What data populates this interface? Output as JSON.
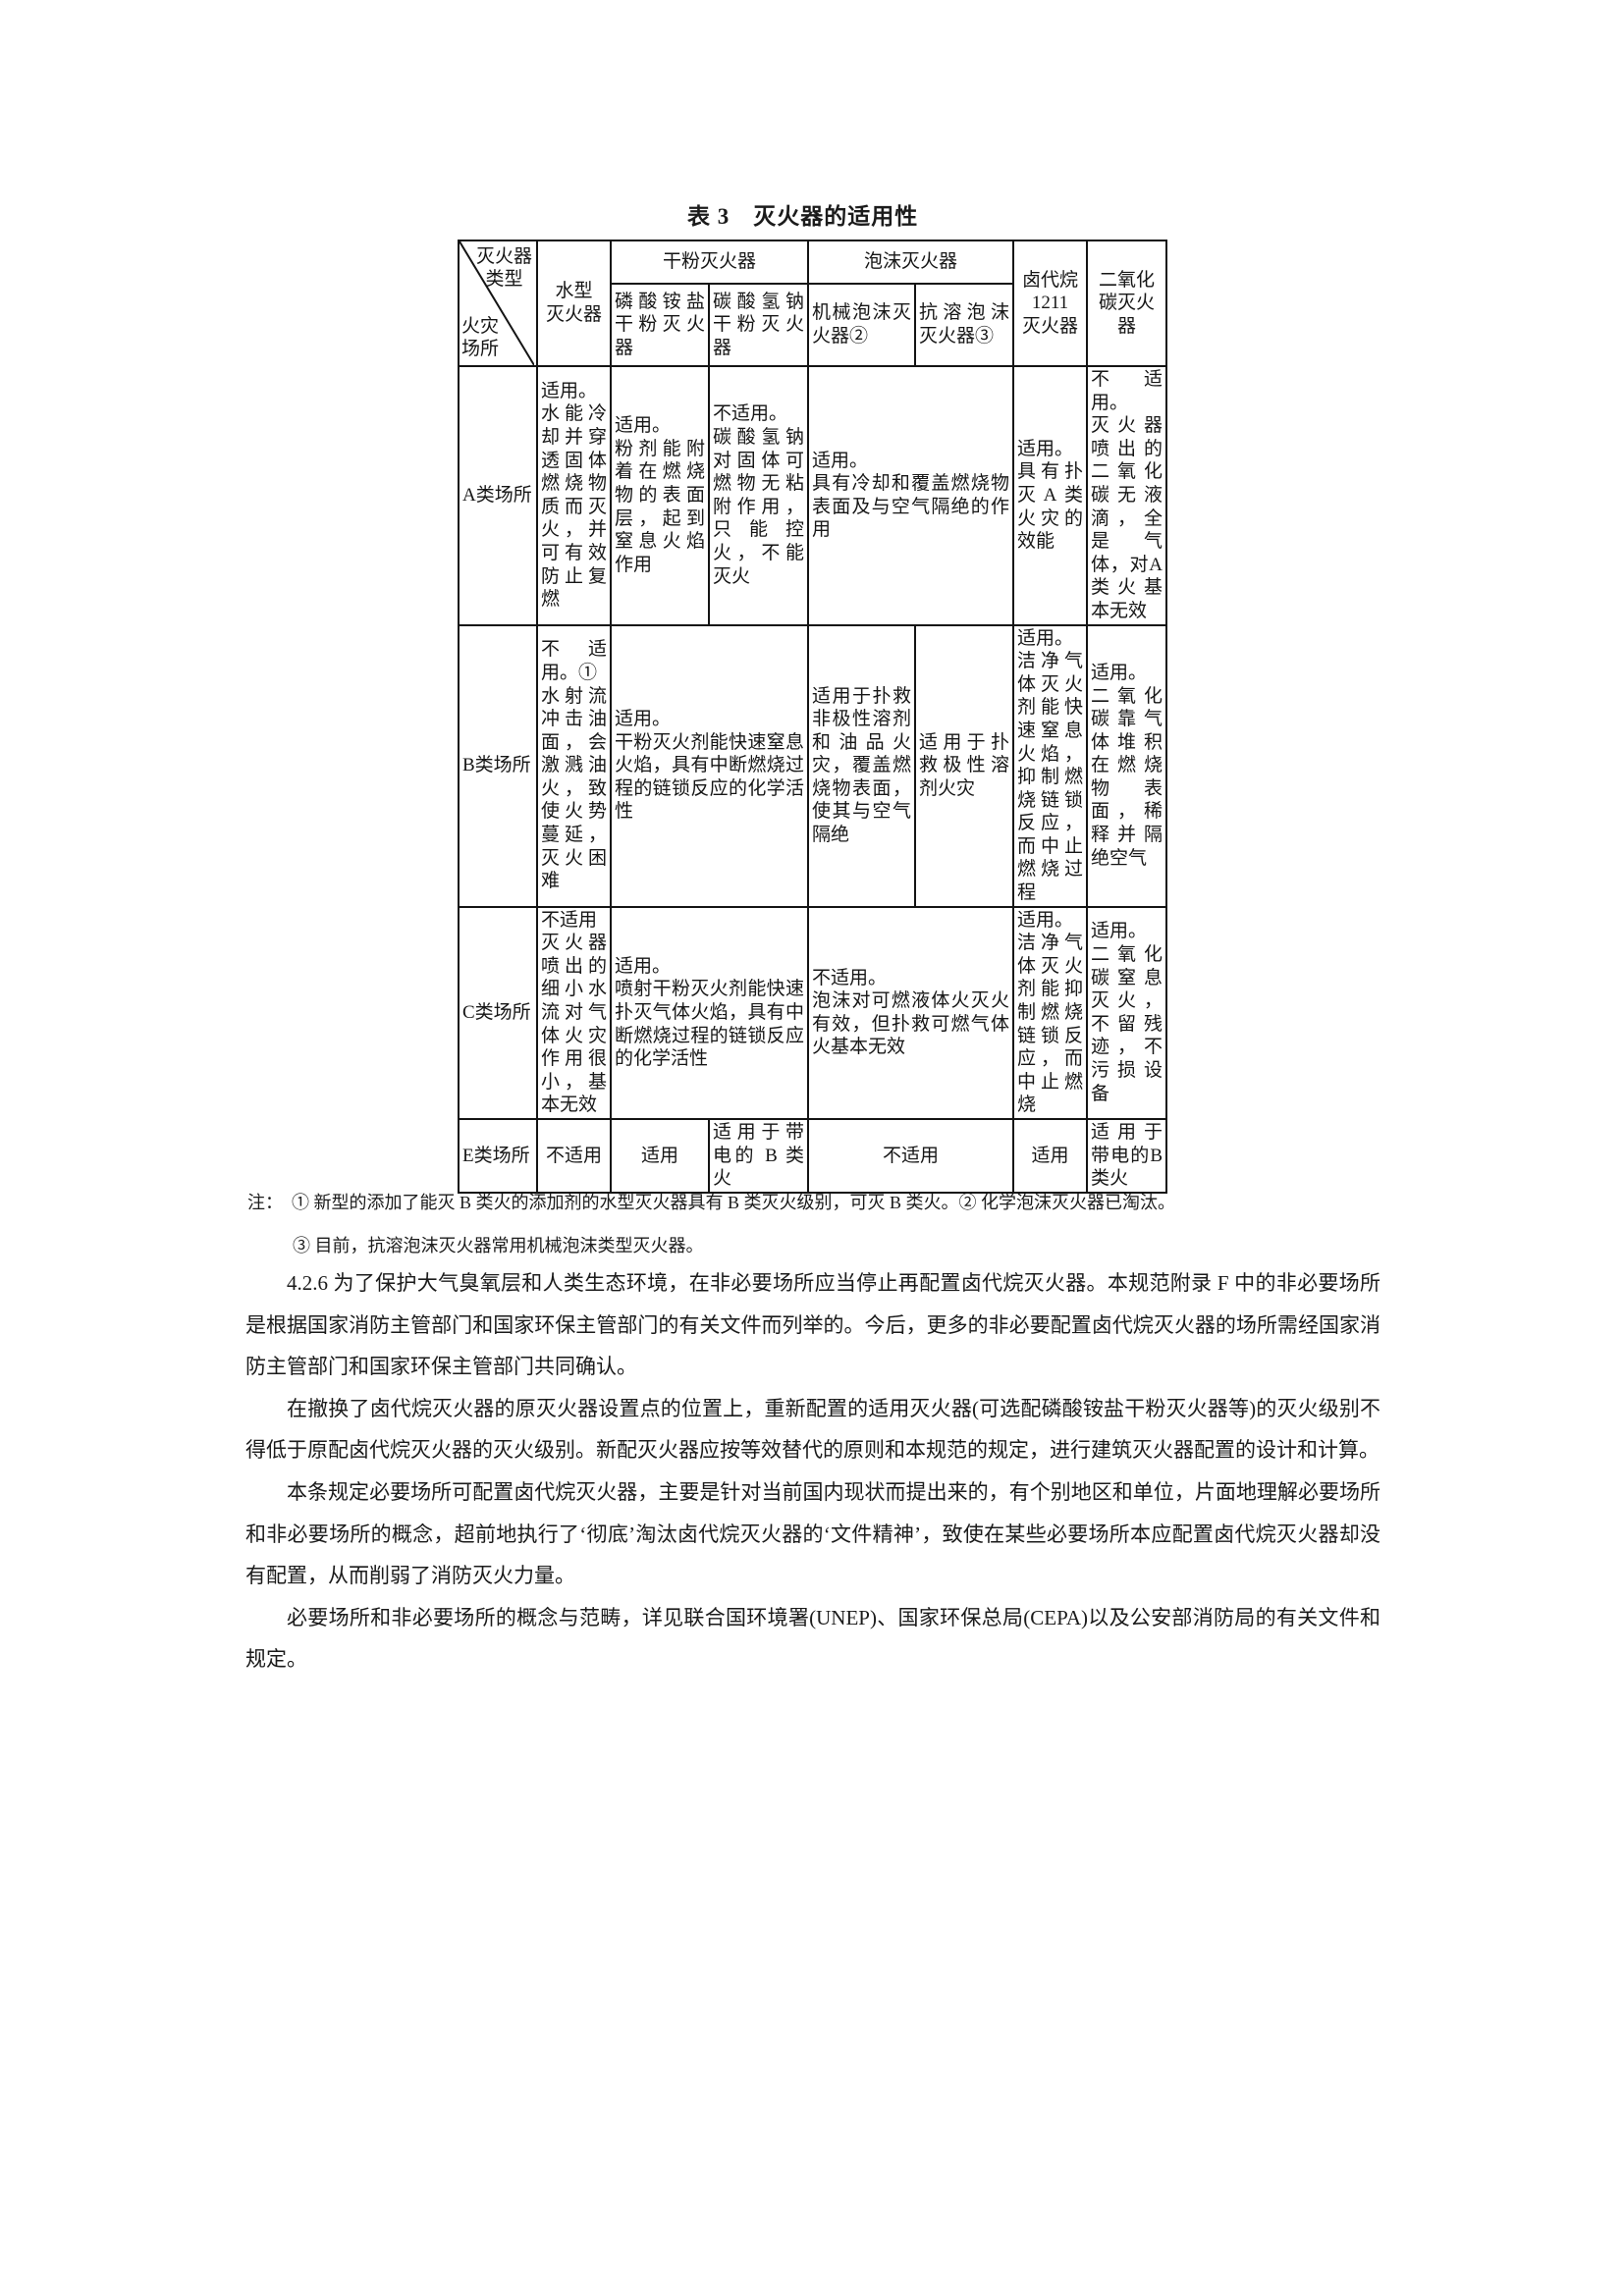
{
  "title": "表 3　灭火器的适用性",
  "table": {
    "header": {
      "diagonal_top": "灭火器\n类型",
      "diagonal_bottom": "火灾\n场所",
      "water": "水型\n灭火器",
      "dry_powder_group": "干粉灭火器",
      "foam_group": "泡沫灭火器",
      "abc_powder": "磷酸铵盐干粉灭火器",
      "bc_powder": "碳酸氢钠干粉灭火器",
      "mech_foam": "机械泡沫灭火器②",
      "ar_foam": "抗溶泡沫灭火器③",
      "halon": "卤代烷\n1211\n灭火器",
      "co2": "二氧化\n碳灭火\n器"
    },
    "rows": {
      "a": {
        "label": "A类场所",
        "water": "适用。\n水能冷却并穿透固体燃烧物质而灭火，并可有效防止复燃",
        "abc_powder": "适用。\n粉剂能附着在燃烧物的表面层，起到窒息火焰作用",
        "bc_powder": "不适用。\n碳酸氢钠对固体可燃物无粘附作用，只能控火，不能灭火",
        "foam": "适用。\n具有冷却和覆盖燃烧物表面及与空气隔绝的作用",
        "halon": "适用。\n具有扑灭A类火灾的效能",
        "co2": "不适用。\n灭火器喷出的二氧化碳无液滴，全是气体，对A类火基本无效"
      },
      "b": {
        "label": "B类场所",
        "water": "不适用。①\n水射流冲击油面，会激溅油火，致使火势蔓延，灭火困难",
        "dry_powder": "适用。\n干粉灭火剂能快速窒息火焰，具有中断燃烧过程的链锁反应的化学活性",
        "mech_foam": "适用于扑救非极性溶剂和油品火灾，覆盖燃烧物表面，使其与空气隔绝",
        "ar_foam": "适用于扑救极性溶剂火灾",
        "halon": "适用。\n洁净气体灭火剂能快速窒息火焰，抑制燃烧链锁反应，而中止燃烧过程",
        "co2": "适用。\n二氧化碳靠气体堆积在燃烧物表面，稀释并隔绝空气"
      },
      "c": {
        "label": "C类场所",
        "water": "不适用\n灭火器喷出的细小水流对气体火灾作用很小，基本无效",
        "dry_powder": "适用。\n喷射干粉灭火剂能快速扑灭气体火焰，具有中断燃烧过程的链锁反应的化学活性",
        "foam": "不适用。\n泡沫对可燃液体火灭火有效，但扑救可燃气体火基本无效",
        "halon": "适用。\n洁净气体灭火剂能抑制燃烧链锁反应，而中止燃烧",
        "co2": "适用。\n二氧化碳窒息灭火，不留残迹，不污损设备"
      },
      "e": {
        "label": "E类场所",
        "water": "不适用",
        "abc_powder": "适用",
        "bc_powder": "适用于带电的 B 类火",
        "foam": "不适用",
        "halon": "适用",
        "co2": "适用于带电的B类火"
      }
    }
  },
  "notes": {
    "line1": "注：　① 新型的添加了能灭 B 类火的添加剂的水型灭火器具有 B 类灭火级别，可灭 B 类火。② 化学泡沫灭火器已淘汰。",
    "line2": "③ 目前，抗溶泡沫灭火器常用机械泡沫类型灭火器。"
  },
  "paragraphs": [
    "4.2.6 为了保护大气臭氧层和人类生态环境，在非必要场所应当停止再配置卤代烷灭火器。本规范附录 F 中的非必要场所是根据国家消防主管部门和国家环保主管部门的有关文件而列举的。今后，更多的非必要配置卤代烷灭火器的场所需经国家消防主管部门和国家环保主管部门共同确认。",
    "在撤换了卤代烷灭火器的原灭火器设置点的位置上，重新配置的适用灭火器(可选配磷酸铵盐干粉灭火器等)的灭火级别不得低于原配卤代烷灭火器的灭火级别。新配灭火器应按等效替代的原则和本规范的规定，进行建筑灭火器配置的设计和计算。",
    "本条规定必要场所可配置卤代烷灭火器，主要是针对当前国内现状而提出来的，有个别地区和单位，片面地理解必要场所和非必要场所的概念，超前地执行了‘彻底’淘汰卤代烷灭火器的‘文件精神’，致使在某些必要场所本应配置卤代烷灭火器却没有配置，从而削弱了消防灭火力量。",
    "必要场所和非必要场所的概念与范畴，详见联合国环境署(UNEP)、国家环保总局(CEPA)以及公安部消防局的有关文件和规定。"
  ]
}
